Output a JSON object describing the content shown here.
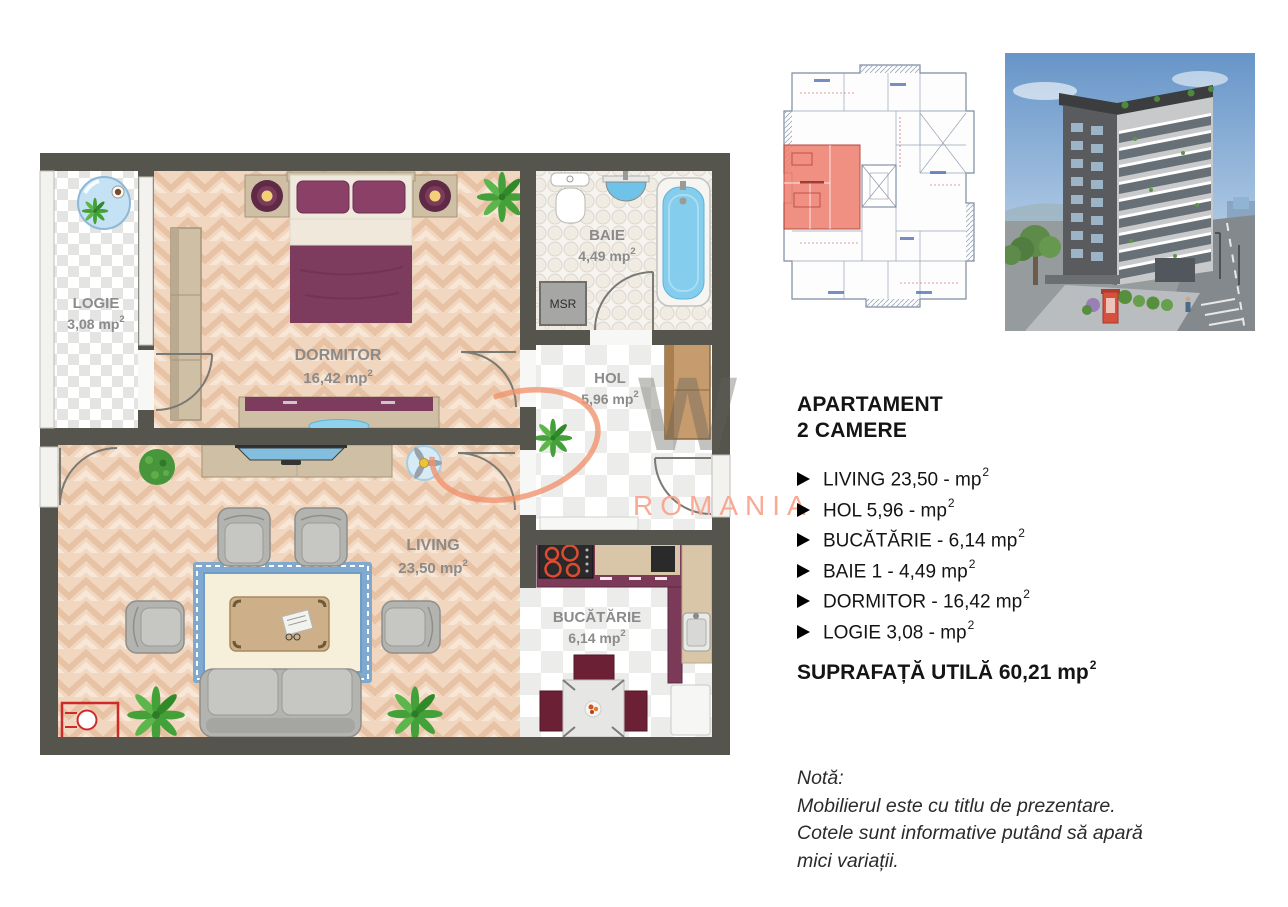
{
  "plan": {
    "sup": "2",
    "rooms": {
      "logie": {
        "name": "LOGIE",
        "area": "3,08 mp"
      },
      "dormitor": {
        "name": "DORMITOR",
        "area": "16,42 mp"
      },
      "baie": {
        "name": "BAIE",
        "area": "4,49 mp"
      },
      "hol": {
        "name": "HOL",
        "area": "5,96 mp"
      },
      "living": {
        "name": "LIVING",
        "area": "23,50 mp"
      },
      "bucatarie": {
        "name": "BUCĂTĂRIE",
        "area": "6,14 mp"
      }
    },
    "labels": {
      "msr": "MSR"
    }
  },
  "watermark": {
    "letter": "W",
    "romania": "ROMANIA",
    "orange": "#f0946e",
    "salmon": "#f8a690"
  },
  "details": {
    "title_line1": "APARTAMENT",
    "title_line2": "2 CAMERE",
    "items": [
      {
        "text": "LIVING 23,50 - mp",
        "sup": "2"
      },
      {
        "text": "HOL 5,96 - mp",
        "sup": "2"
      },
      {
        "text": "BUCĂTĂRIE - 6,14 mp",
        "sup": "2"
      },
      {
        "text": "BAIE 1 - 4,49 mp",
        "sup": "2"
      },
      {
        "text": "DORMITOR - 16,42 mp",
        "sup": "2"
      },
      {
        "text": "LOGIE 3,08 - mp",
        "sup": "2"
      }
    ],
    "total": {
      "text": "SUPRAFAȚĂ UTILĂ 60,21 mp",
      "sup": "2"
    },
    "note": {
      "line1": "Notă:",
      "line2": "Mobilierul este cu titlu de prezentare.",
      "line3": "Cotele sunt informative putând să apară",
      "line4": "mici variații."
    }
  },
  "colors": {
    "wall": "#56554d",
    "parquet": "#f2d7c0",
    "plum": "#7d3b5e",
    "tan_furniture": "#cfc0a5",
    "fixture_blue": "#85cdec",
    "accent_red": "#cf2a2a"
  }
}
